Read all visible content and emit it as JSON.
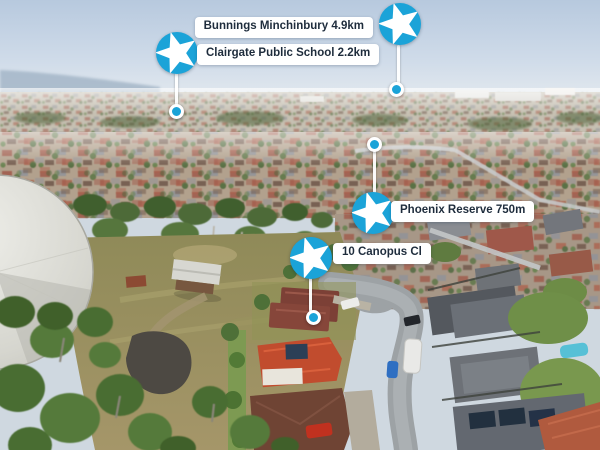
{
  "markers": [
    {
      "id": "bunnings",
      "place": "Bunnings Minchinbury",
      "distance": "4.9km",
      "label": "Bunnings Minchinbury 4.9km"
    },
    {
      "id": "school",
      "place": "Clairgate Public School",
      "distance": "2.2km",
      "label": "Clairgate Public School 2.2km"
    },
    {
      "id": "reserve",
      "place": "Phoenix Reserve",
      "distance": "750m",
      "label": "Phoenix Reserve 750m"
    },
    {
      "id": "subject",
      "place": "10 Canopus Cl",
      "distance": "",
      "label": "10 Canopus Cl"
    }
  ],
  "colors": {
    "marker_blue": "#1ba3d8",
    "label_bg": "#ffffff",
    "label_text": "#1e2c3c"
  }
}
